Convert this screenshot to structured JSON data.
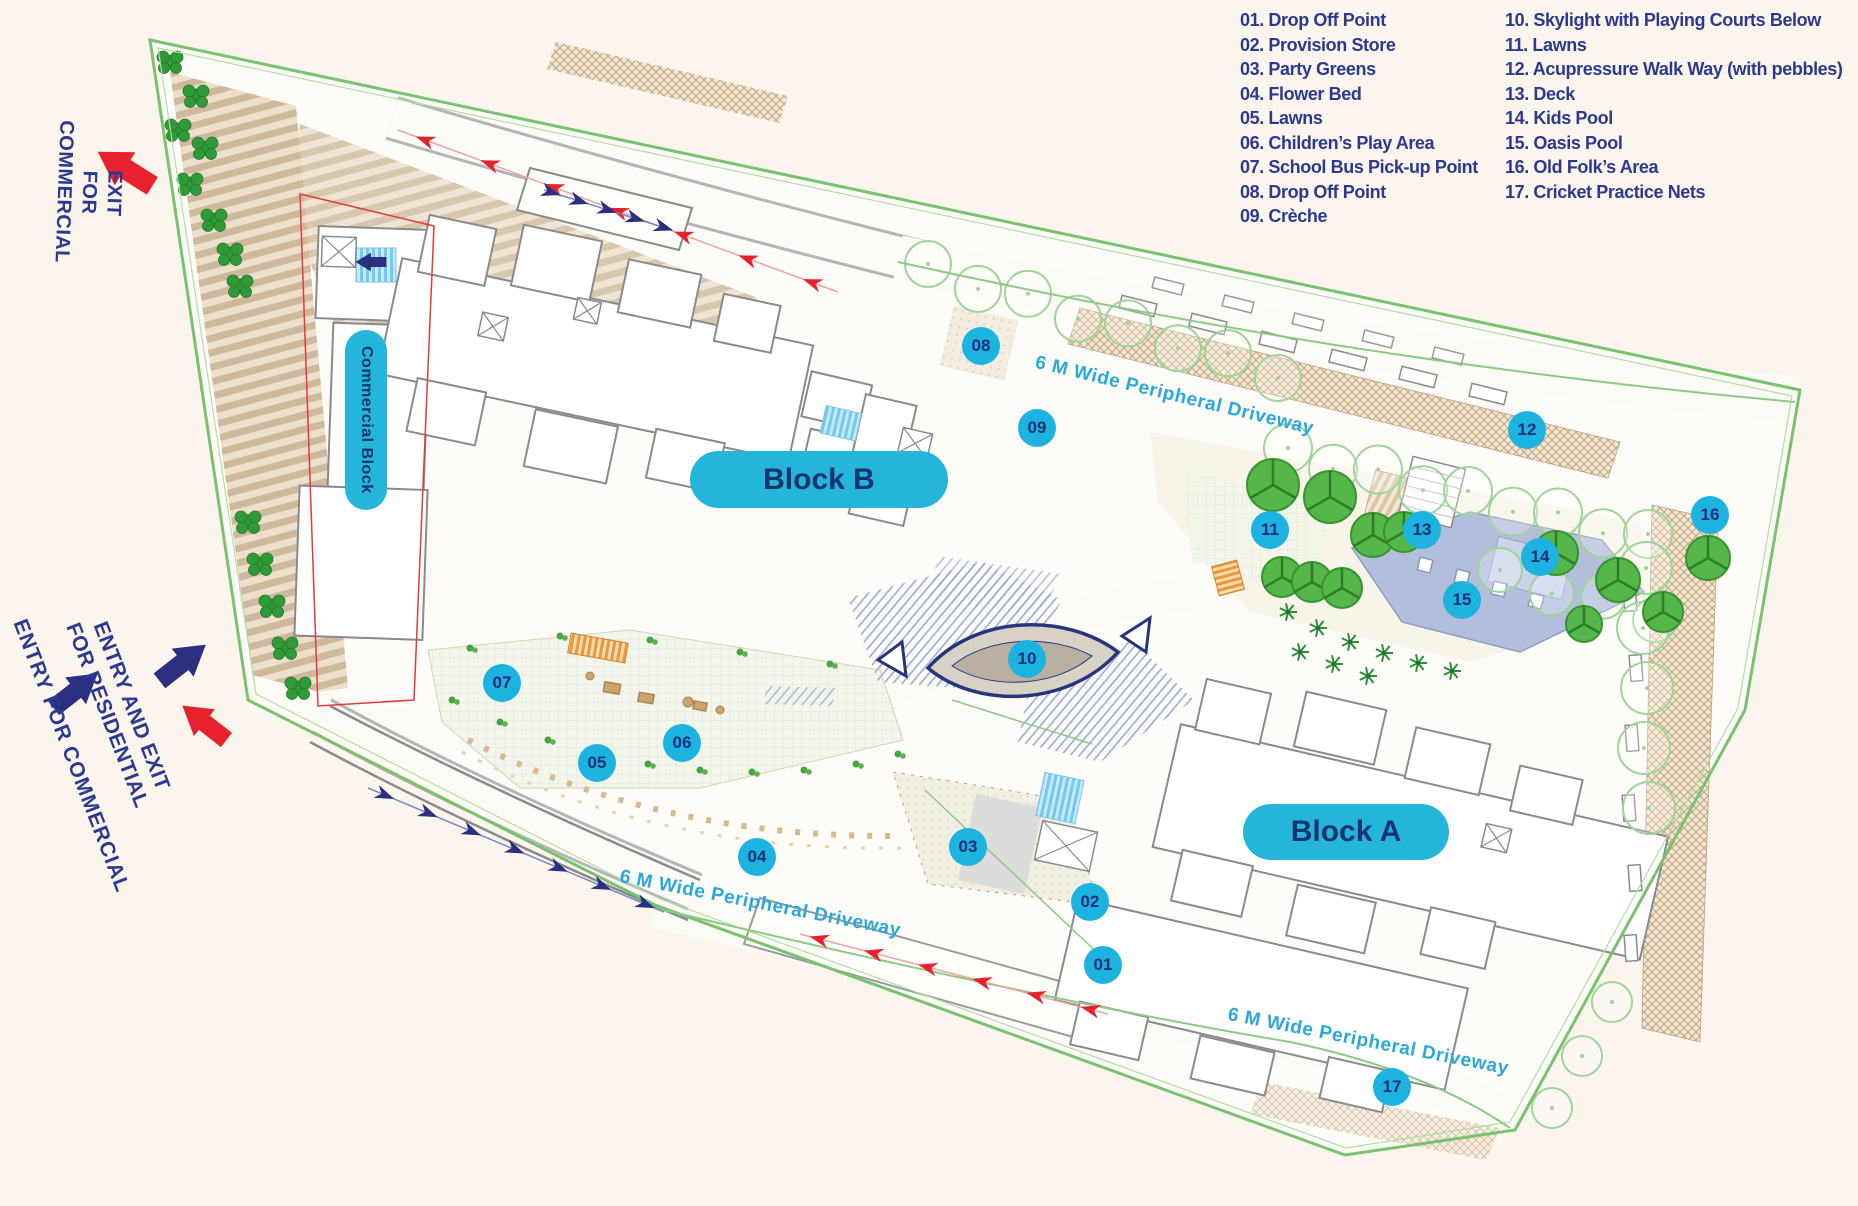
{
  "legend": {
    "column1": [
      "01. Drop Off Point",
      "02. Provision Store",
      "03. Party Greens",
      "04. Flower Bed",
      "05. Lawns",
      "06. Children’s Play Area",
      "07. School Bus Pick-up Point",
      "08. Drop Off Point",
      "09. Crèche"
    ],
    "column2": [
      "10. Skylight with Playing Courts Below",
      "11. Lawns",
      "12. Acupressure Walk Way (with pebbles)",
      "13. Deck",
      "14. Kids Pool",
      "15. Oasis Pool",
      "16. Old Folk’s Area",
      "17. Cricket Practice Nets"
    ]
  },
  "blocks": {
    "block_a": "Block A",
    "block_b": "Block B",
    "commercial": "Commercial Block"
  },
  "driveway_labels": {
    "top": "6 M Wide Peripheral Driveway",
    "bottom_left": "6 M Wide Peripheral Driveway",
    "bottom_right": "6 M Wide Peripheral Driveway"
  },
  "annotations": {
    "exit_commercial_line1": "EXIT",
    "exit_commercial_line2": "FOR COMMERCIAL",
    "entry_commercial": "ENTRY FOR COMMERCIAL",
    "entry_exit_residential_line1": "ENTRY AND EXIT",
    "entry_exit_residential_line2": "FOR RESIDENTIAL"
  },
  "markers": [
    {
      "num": "01",
      "x": 1103,
      "y": 965
    },
    {
      "num": "02",
      "x": 1090,
      "y": 902
    },
    {
      "num": "03",
      "x": 968,
      "y": 847
    },
    {
      "num": "04",
      "x": 757,
      "y": 857
    },
    {
      "num": "05",
      "x": 597,
      "y": 763
    },
    {
      "num": "06",
      "x": 682,
      "y": 743
    },
    {
      "num": "07",
      "x": 502,
      "y": 683
    },
    {
      "num": "08",
      "x": 981,
      "y": 346
    },
    {
      "num": "09",
      "x": 1037,
      "y": 428
    },
    {
      "num": "10",
      "x": 1027,
      "y": 659
    },
    {
      "num": "11",
      "x": 1270,
      "y": 530
    },
    {
      "num": "12",
      "x": 1527,
      "y": 430
    },
    {
      "num": "13",
      "x": 1422,
      "y": 530
    },
    {
      "num": "14",
      "x": 1540,
      "y": 557
    },
    {
      "num": "15",
      "x": 1462,
      "y": 600
    },
    {
      "num": "16",
      "x": 1710,
      "y": 515
    },
    {
      "num": "17",
      "x": 1392,
      "y": 1087
    }
  ],
  "colors": {
    "bg": "#fbf5ee",
    "site": "#fefcf8",
    "green": "#79c36f",
    "legend": "#2b3990",
    "cyan": "#24b6da",
    "cyantext": "#153271",
    "marker": "#1db3e0",
    "markertext": "#1c2f77",
    "skyblue": "#2aa7df",
    "red": "#e8222d",
    "navy": "#2b2f7f"
  }
}
